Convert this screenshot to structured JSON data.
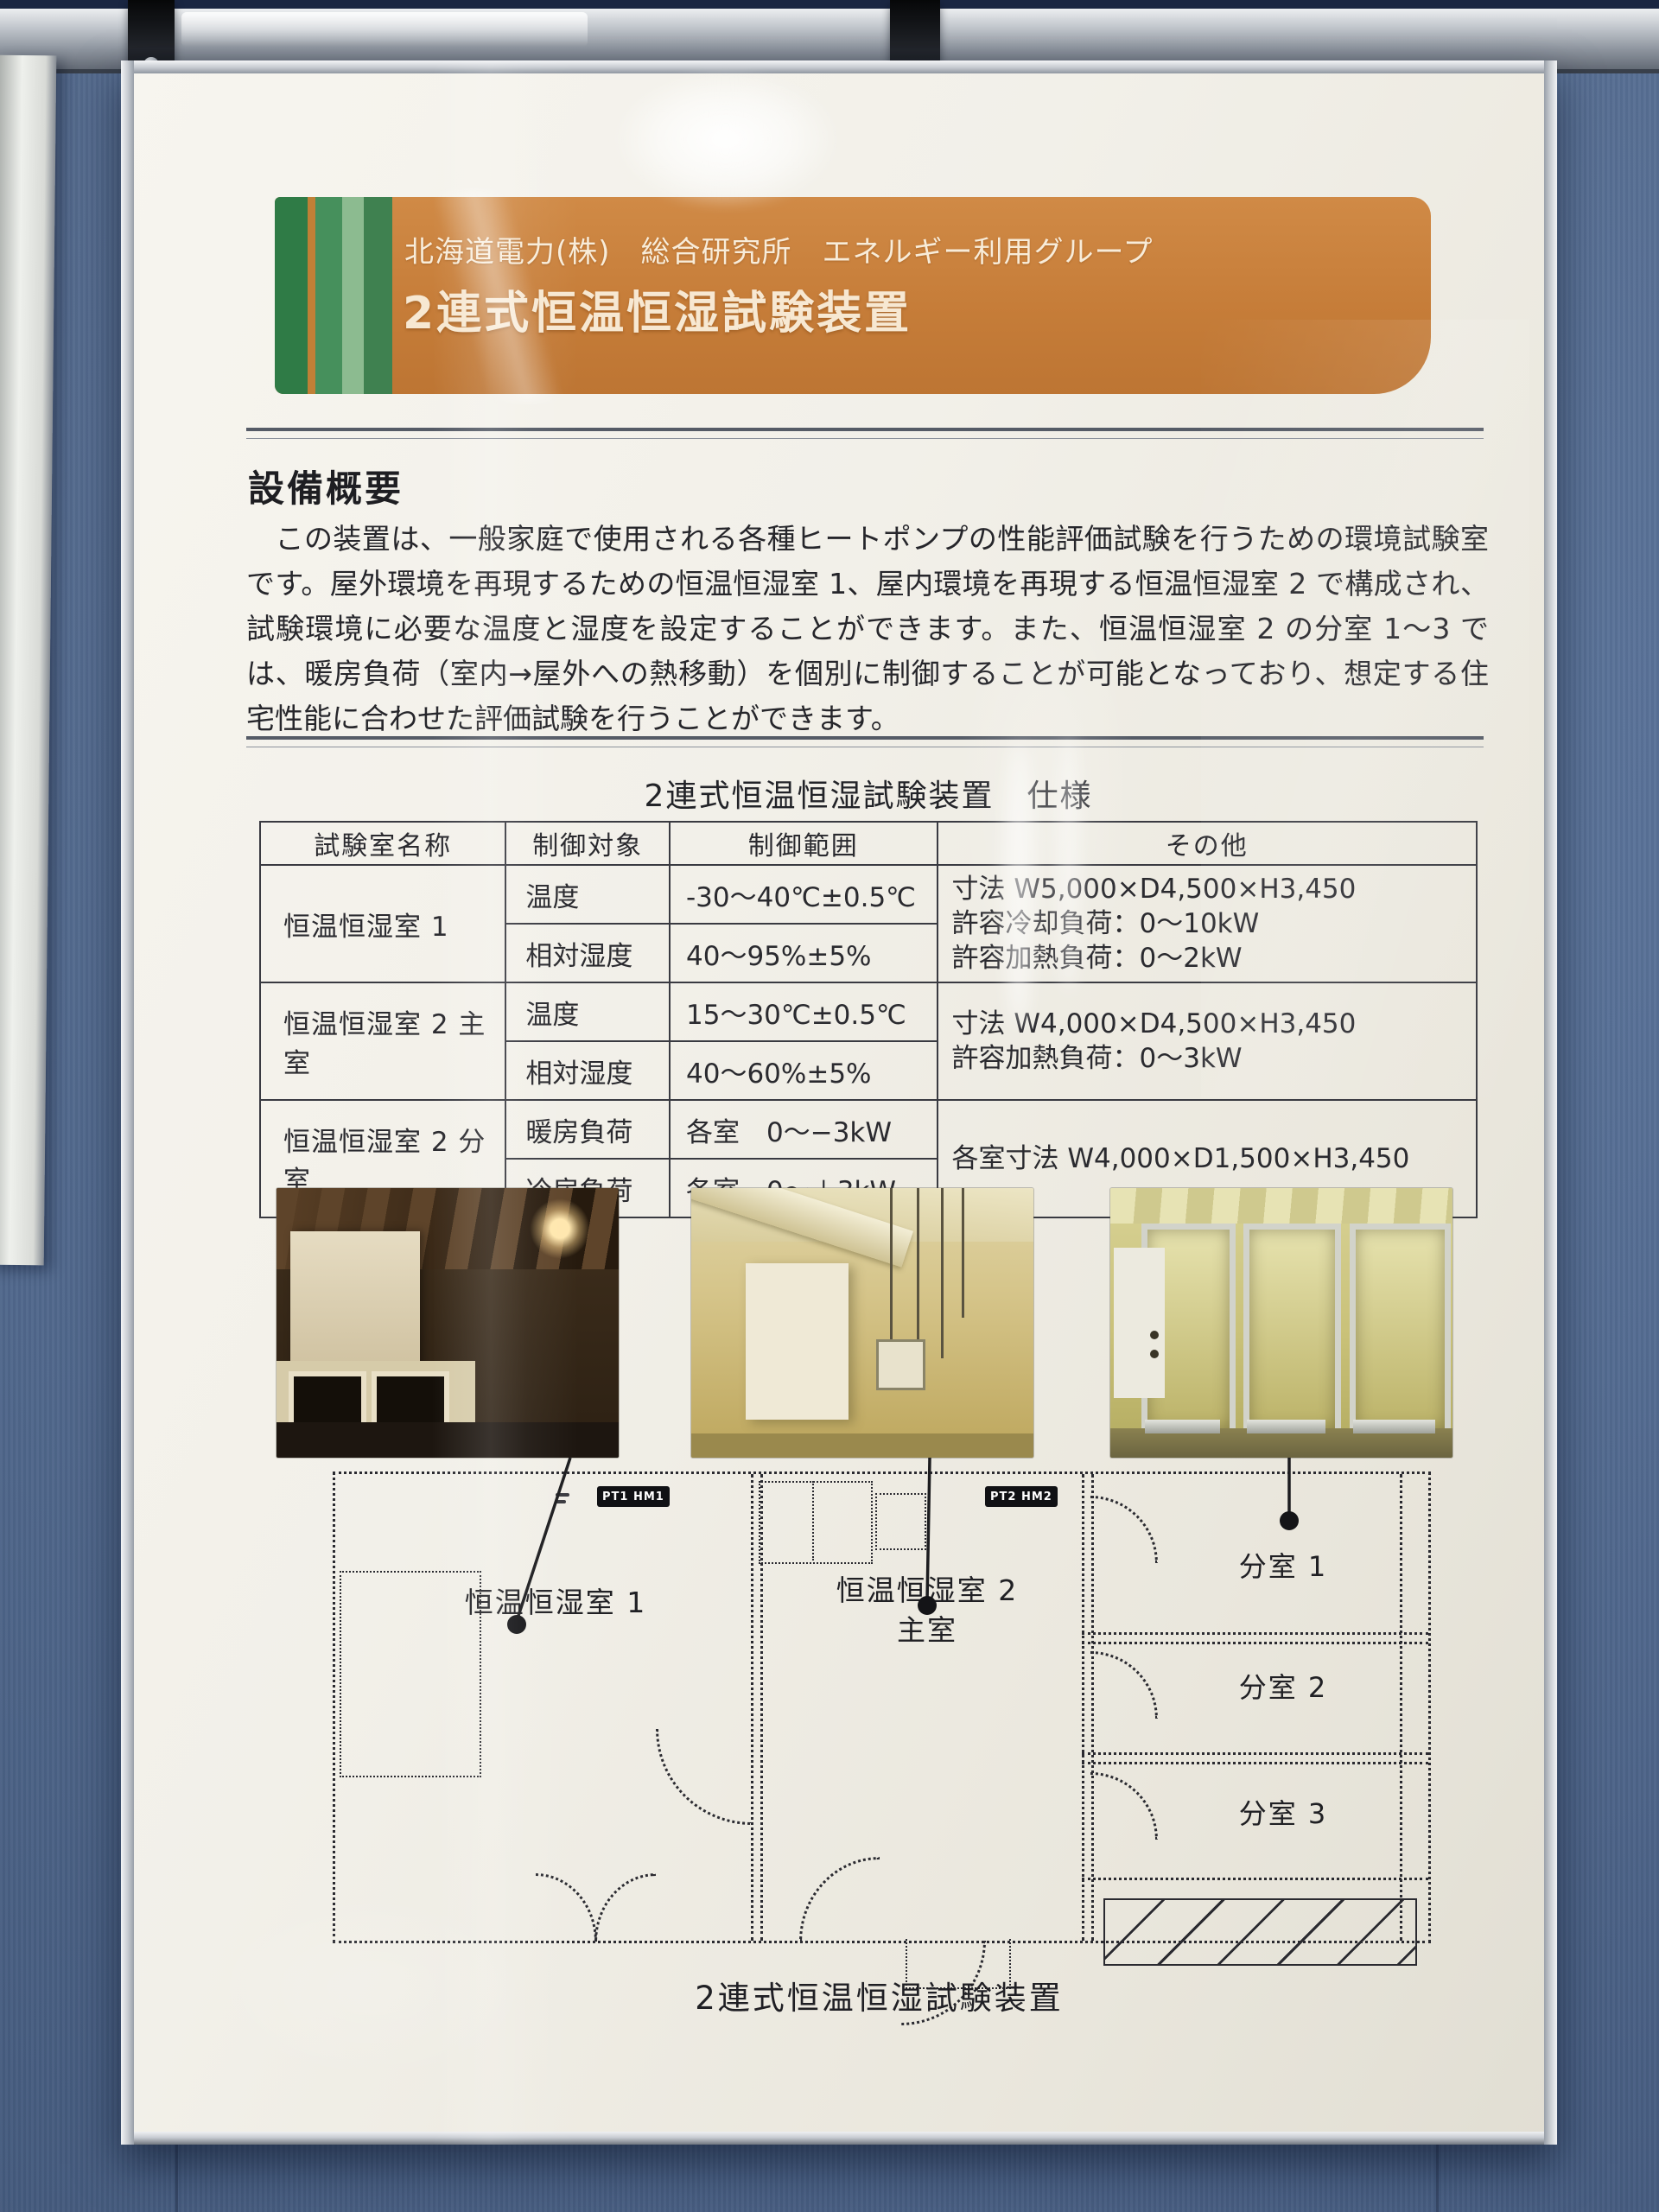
{
  "banner": {
    "org": "北海道電力(株)　総合研究所　エネルギー利用グループ",
    "title": "2連式恒温恒湿試験装置"
  },
  "overview": {
    "heading": "設備概要",
    "body": "　この装置は、一般家庭で使用される各種ヒートポンプの性能評価試験を行うための環境試験室です。屋外環境を再現するための恒温恒湿室 1、屋内環境を再現する恒温恒湿室 2 で構成され、試験環境に必要な温度と湿度を設定することができます。また、恒温恒湿室 2 の分室 1〜3 では、暖房負荷（室内→屋外への熱移動）を個別に制御することが可能となっており、想定する住宅性能に合わせた評価試験を行うことができます。"
  },
  "spec": {
    "title": "2連式恒温恒湿試験装置　仕様",
    "headers": {
      "room": "試験室名称",
      "target": "制御対象",
      "range": "制御範囲",
      "other": "その他"
    },
    "rows": [
      {
        "room": "恒温恒湿室 1",
        "targets": [
          "温度",
          "相対湿度"
        ],
        "ranges": [
          "-30〜40℃±0.5℃",
          "40〜95%±5%"
        ],
        "other_lines": [
          "寸法 W5,000×D4,500×H3,450",
          "許容冷却負荷：0〜10kW",
          "許容加熱負荷：0〜2kW"
        ]
      },
      {
        "room": "恒温恒湿室 2 主室",
        "targets": [
          "温度",
          "相対湿度"
        ],
        "ranges": [
          "15〜30℃±0.5℃",
          "40〜60%±5%"
        ],
        "other_lines": [
          "寸法 W4,000×D4,500×H3,450",
          "許容加熱負荷：0〜3kW"
        ]
      },
      {
        "room": "恒温恒湿室 2 分室",
        "targets": [
          "暖房負荷",
          "冷房負荷"
        ],
        "ranges": [
          "各室　0〜−3kW",
          "各室　0〜＋3kW"
        ],
        "other_lines": [
          "各室寸法 W4,000×D1,500×H3,450"
        ]
      }
    ]
  },
  "plan": {
    "room1": "恒温恒湿室 1",
    "room2_line1": "恒温恒湿室 2",
    "room2_line2": "主室",
    "sub1": "分室 1",
    "sub2": "分室 2",
    "sub3": "分室 3",
    "tag1": "PT1 HM1",
    "tag2": "PT2 HM2",
    "caption": "2連式恒温恒湿試験装置"
  },
  "colors": {
    "banner_orange": "#c67d39",
    "stripe_green_dark": "#2f7b46",
    "stripe_green_light": "#8cbb90",
    "wall_blue": "#56719b",
    "frame_aluminum": "#c6cad0"
  }
}
